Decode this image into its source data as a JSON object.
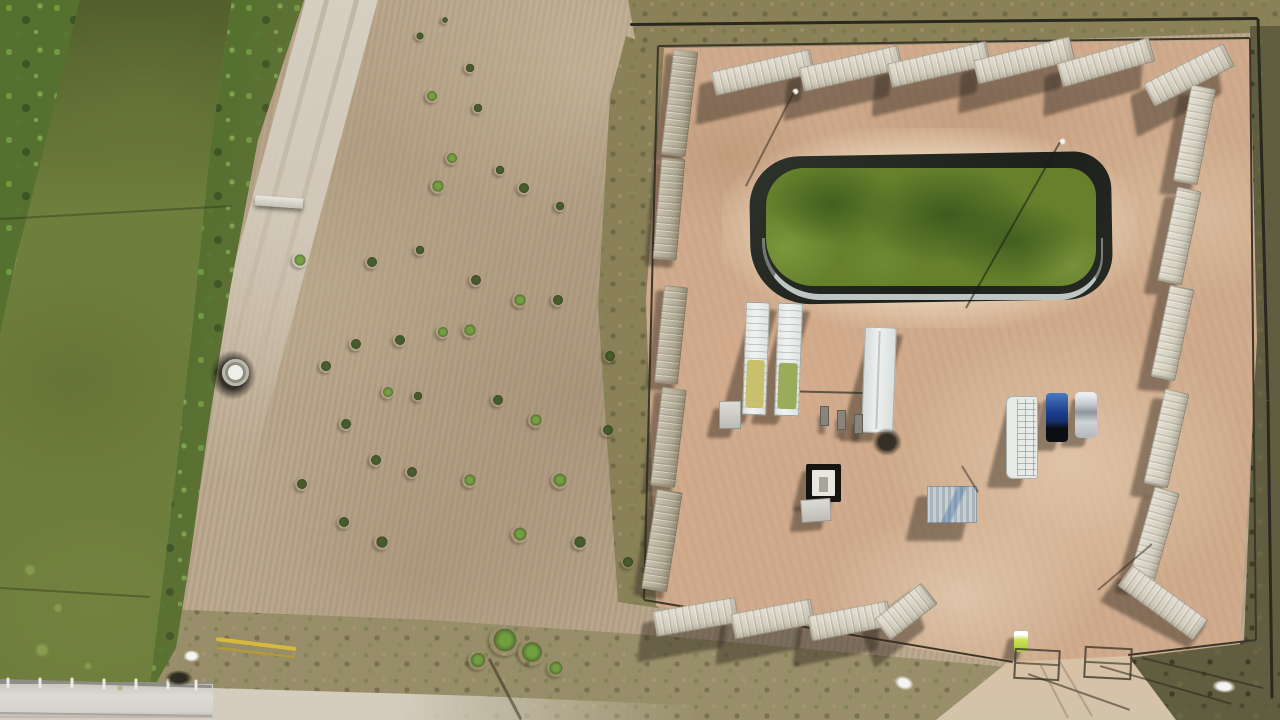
{
  "palette": {
    "field": "#b9a68b",
    "road": "#d4cdbe",
    "canal": "#6e7e3c",
    "veg": "#55702f",
    "veg-bright": "#74a244",
    "veg-dark": "#3c5226",
    "grass": "#8a8159",
    "scrub": "#615d40",
    "pad": "#d0ab8d",
    "pad-light": "#e2c6a8",
    "liner": "#23261f",
    "pond": "#66802c",
    "pond-dark": "#42601f",
    "silver": "#ccd3d1",
    "cont": "#d9d3c1",
    "cont-weathered": "#b3a98f",
    "white": "#eceeec",
    "fence": "#3b382b",
    "truck": "#1c3e8c",
    "car": "#c7cbd0",
    "yellow": "#d8b93c",
    "toilet": "#cde24f",
    "bridge": "#d8d6ce"
  },
  "scene": {
    "shrubs": [
      [
        432,
        96,
        7,
        "b"
      ],
      [
        470,
        68,
        6,
        "d"
      ],
      [
        478,
        108,
        6,
        "d"
      ],
      [
        452,
        158,
        7,
        "b"
      ],
      [
        438,
        186,
        8,
        "b"
      ],
      [
        500,
        170,
        6,
        "d"
      ],
      [
        524,
        188,
        7,
        "d"
      ],
      [
        560,
        206,
        6,
        "d"
      ],
      [
        420,
        250,
        6,
        "d"
      ],
      [
        372,
        262,
        7,
        "d"
      ],
      [
        300,
        260,
        8,
        "b"
      ],
      [
        476,
        280,
        7,
        "d"
      ],
      [
        520,
        300,
        8,
        "b"
      ],
      [
        558,
        300,
        7,
        "d"
      ],
      [
        610,
        356,
        7,
        "d"
      ],
      [
        470,
        330,
        8,
        "b"
      ],
      [
        443,
        332,
        7,
        "b"
      ],
      [
        400,
        340,
        7,
        "d"
      ],
      [
        356,
        344,
        7,
        "d"
      ],
      [
        326,
        366,
        7,
        "d"
      ],
      [
        388,
        392,
        7,
        "b"
      ],
      [
        418,
        396,
        6,
        "d"
      ],
      [
        498,
        400,
        7,
        "d"
      ],
      [
        536,
        420,
        8,
        "b"
      ],
      [
        346,
        424,
        7,
        "d"
      ],
      [
        376,
        460,
        7,
        "d"
      ],
      [
        412,
        472,
        7,
        "d"
      ],
      [
        470,
        480,
        8,
        "b"
      ],
      [
        560,
        480,
        9,
        "b"
      ],
      [
        520,
        534,
        9,
        "b"
      ],
      [
        382,
        542,
        8,
        "d"
      ],
      [
        344,
        522,
        7,
        "d"
      ],
      [
        302,
        484,
        7,
        "d"
      ],
      [
        580,
        542,
        8,
        "d"
      ],
      [
        628,
        562,
        7,
        "d"
      ],
      [
        608,
        430,
        7,
        "d"
      ],
      [
        420,
        36,
        5,
        "d"
      ],
      [
        445,
        20,
        4,
        "d"
      ],
      [
        505,
        640,
        16,
        "b"
      ],
      [
        532,
        652,
        14,
        "b"
      ],
      [
        478,
        660,
        10,
        "b"
      ],
      [
        556,
        668,
        9,
        "b"
      ],
      [
        30,
        570,
        9,
        "a"
      ],
      [
        58,
        608,
        7,
        "a"
      ],
      [
        42,
        650,
        11,
        "a"
      ],
      [
        88,
        666,
        6,
        "a"
      ],
      [
        120,
        688,
        5,
        "a"
      ]
    ],
    "containers": {
      "top": [
        [
          712,
          60,
          102,
          25,
          -13
        ],
        [
          800,
          56,
          102,
          25,
          -13
        ],
        [
          888,
          52,
          102,
          25,
          -13
        ],
        [
          974,
          48,
          100,
          25,
          -14
        ],
        [
          1058,
          50,
          96,
          25,
          -16
        ],
        [
          1144,
          62,
          90,
          26,
          -27
        ]
      ],
      "right": [
        [
          1182,
          86,
          25,
          98,
          11
        ],
        [
          1167,
          188,
          25,
          96,
          12
        ],
        [
          1160,
          286,
          25,
          94,
          12
        ],
        [
          1154,
          390,
          25,
          97,
          13
        ],
        [
          1141,
          488,
          26,
          97,
          16
        ],
        [
          1116,
          590,
          94,
          26,
          36
        ]
      ],
      "bottom": [
        [
          654,
          604,
          84,
          26,
          -10
        ],
        [
          732,
          606,
          82,
          26,
          -11
        ],
        [
          809,
          608,
          82,
          26,
          -11
        ],
        [
          876,
          598,
          60,
          27,
          -38
        ]
      ],
      "left": [
        [
          667,
          50,
          25,
          106,
          7
        ],
        [
          657,
          158,
          24,
          102,
          5
        ],
        [
          659,
          286,
          24,
          98,
          6
        ],
        [
          656,
          388,
          25,
          99,
          7
        ],
        [
          649,
          490,
          26,
          101,
          9
        ]
      ]
    },
    "equipment": [
      {
        "type": "white-unit",
        "x": 744,
        "y": 302,
        "w": 24,
        "h": 113,
        "rot": 2,
        "tank": "#c6be66",
        "tankY": 58,
        "tankH": 48
      },
      {
        "type": "white-unit",
        "x": 776,
        "y": 303,
        "w": 25,
        "h": 113,
        "rot": 2,
        "tank": "#97a854",
        "tankY": 60,
        "tankH": 46
      },
      {
        "type": "trailer",
        "x": 863,
        "y": 327,
        "w": 32,
        "h": 106,
        "rot": 2
      },
      {
        "type": "dark-blob",
        "x": 872,
        "y": 428,
        "w": 30,
        "h": 28,
        "rot": 0
      },
      {
        "type": "grid-trailer",
        "x": 1006,
        "y": 396,
        "w": 32,
        "h": 83,
        "rot": 0
      },
      {
        "type": "pickup",
        "x": 1046,
        "y": 393,
        "w": 22,
        "h": 49,
        "rot": 0
      },
      {
        "type": "car",
        "x": 1075,
        "y": 392,
        "w": 22,
        "h": 46,
        "rot": 0
      },
      {
        "type": "wellpad",
        "x": 806,
        "y": 464,
        "w": 35,
        "h": 38,
        "rot": 0
      },
      {
        "type": "box",
        "x": 801,
        "y": 499,
        "w": 30,
        "h": 23,
        "rot": -4
      },
      {
        "type": "shed",
        "x": 927,
        "y": 486,
        "w": 50,
        "h": 37,
        "rot": 0
      },
      {
        "type": "box",
        "x": 719,
        "y": 401,
        "w": 22,
        "h": 28,
        "rot": 0
      },
      {
        "type": "manifold",
        "x": 820,
        "y": 406,
        "w": 9,
        "h": 20,
        "rot": 0
      },
      {
        "type": "manifold",
        "x": 837,
        "y": 410,
        "w": 9,
        "h": 20,
        "rot": 0
      },
      {
        "type": "manifold",
        "x": 854,
        "y": 414,
        "w": 9,
        "h": 20,
        "rot": 0
      },
      {
        "type": "toilet",
        "x": 1014,
        "y": 631,
        "w": 14,
        "h": 21,
        "rot": 0
      },
      {
        "type": "blob-white",
        "x": 894,
        "y": 676,
        "w": 20,
        "h": 14,
        "rot": 20
      },
      {
        "type": "blob-white",
        "x": 1212,
        "y": 680,
        "w": 24,
        "h": 13,
        "rot": 5
      },
      {
        "type": "dark-blob",
        "x": 210,
        "y": 350,
        "w": 46,
        "h": 50,
        "rot": 0
      },
      {
        "type": "tank-circle",
        "x": 222,
        "y": 359,
        "w": 27,
        "h": 27,
        "rot": 0
      },
      {
        "type": "footbridge",
        "x": 255,
        "y": 197,
        "w": 48,
        "h": 10,
        "rot": 4
      },
      {
        "type": "blob-white",
        "x": 183,
        "y": 650,
        "w": 17,
        "h": 12,
        "rot": 0
      },
      {
        "type": "dark-blob",
        "x": 165,
        "y": 670,
        "w": 28,
        "h": 16,
        "rot": 0
      },
      {
        "type": "blob-white",
        "x": 792,
        "y": 88,
        "w": 7,
        "h": 7,
        "rot": 0
      },
      {
        "type": "blob-white",
        "x": 1059,
        "y": 138,
        "w": 7,
        "h": 7,
        "rot": 0
      }
    ],
    "gates": [
      {
        "x": 1014,
        "y": 649,
        "w": 42,
        "h": 27,
        "rot": 3
      },
      {
        "x": 1084,
        "y": 647,
        "w": 44,
        "h": 28,
        "rot": 3
      }
    ],
    "lines": [
      [
        658,
        46,
        1250,
        38,
        2,
        "#3b382b",
        "u"
      ],
      [
        630,
        24,
        1258,
        18,
        3,
        "#2b291f",
        "u"
      ],
      [
        1258,
        18,
        1268,
        400,
        3,
        "#2b291f",
        "u"
      ],
      [
        1268,
        400,
        1272,
        698,
        3,
        "#2b291f",
        "u"
      ],
      [
        1250,
        38,
        1256,
        640,
        2,
        "#3b382b",
        "u"
      ],
      [
        1256,
        640,
        1128,
        655,
        2,
        "#3b382b",
        "u"
      ],
      [
        658,
        46,
        644,
        600,
        2,
        "#3b382b",
        "u"
      ],
      [
        644,
        600,
        1013,
        662,
        2,
        "#3b382b",
        "u"
      ],
      [
        776,
        391,
        864,
        393,
        2,
        "#5a5448",
        "u"
      ],
      [
        0,
        680,
        212,
        686,
        3,
        "#8f8d85",
        "u"
      ],
      [
        8,
        677,
        8,
        688,
        3,
        "#ecebe3",
        "u"
      ],
      [
        40,
        677,
        40,
        688,
        3,
        "#ecebe3",
        "u"
      ],
      [
        72,
        677,
        72,
        688,
        3,
        "#ecebe3",
        "u"
      ],
      [
        104,
        678,
        104,
        689,
        3,
        "#ecebe3",
        "u"
      ],
      [
        136,
        678,
        136,
        689,
        3,
        "#ecebe3",
        "u"
      ],
      [
        168,
        678,
        168,
        689,
        3,
        "#ecebe3",
        "u"
      ],
      [
        196,
        679,
        196,
        690,
        3,
        "#ecebe3",
        "u"
      ],
      [
        0,
        713,
        212,
        716,
        2,
        "#a8a69e",
        "u"
      ],
      [
        0,
        219,
        232,
        206,
        2,
        "rgba(20,25,15,0.3)",
        "t"
      ],
      [
        0,
        588,
        150,
        597,
        2,
        "rgba(20,25,15,0.3)",
        "t"
      ],
      [
        1060,
        142,
        966,
        308,
        2,
        "rgba(25,28,18,0.55)",
        "t"
      ],
      [
        794,
        92,
        746,
        186,
        2,
        "rgba(45,38,28,0.5)",
        "t"
      ],
      [
        489,
        658,
        521,
        719,
        3,
        "rgba(45,38,28,0.5)",
        "t"
      ],
      [
        1100,
        666,
        1232,
        704,
        2,
        "rgba(45,38,28,0.55)",
        "t"
      ],
      [
        1142,
        658,
        1263,
        688,
        2,
        "rgba(45,38,28,0.55)",
        "t"
      ],
      [
        1028,
        674,
        1130,
        710,
        2,
        "rgba(45,38,28,0.55)",
        "t"
      ],
      [
        1152,
        544,
        1098,
        590,
        2,
        "rgba(45,38,28,0.5)",
        "t"
      ],
      [
        962,
        466,
        978,
        492,
        2,
        "rgba(45,38,28,0.5)",
        "t"
      ],
      [
        216,
        639,
        296,
        649,
        4,
        "#d8b93c",
        "t"
      ],
      [
        218,
        648,
        294,
        657,
        2,
        "#b89c2e",
        "t"
      ],
      [
        1040,
        664,
        1068,
        718,
        2,
        "rgba(120,95,75,0.35)",
        "t"
      ],
      [
        1060,
        662,
        1092,
        716,
        2,
        "rgba(120,95,75,0.35)",
        "t"
      ]
    ]
  }
}
